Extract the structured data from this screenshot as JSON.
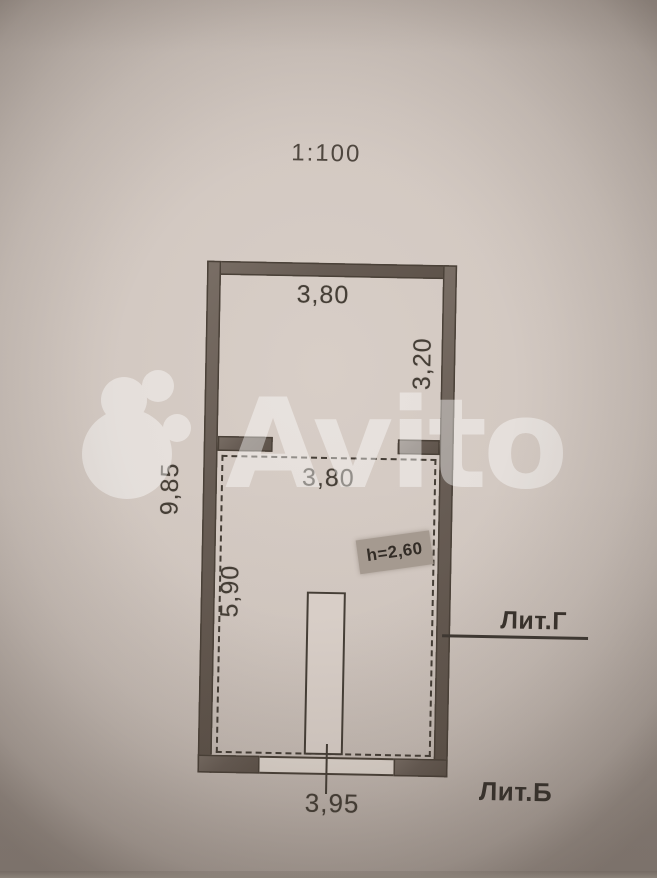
{
  "photo": {
    "scale_label": "1:100",
    "watermark_text": "Avito"
  },
  "upper_room": {
    "width_dim": "3,80",
    "depth_dim": "3,20"
  },
  "lower_room": {
    "width_dim": "3,80",
    "depth_dim": "5,90",
    "ceiling_height_stamp": "h=2,60"
  },
  "overall": {
    "total_depth_dim": "9,85",
    "bottom_width_dim": "3,95"
  },
  "building_labels": {
    "lit_g": "Лит.Г",
    "lit_b": "Лит.Б"
  },
  "colors": {
    "paper": "#d2c8c1",
    "wall_fill": "#675c54",
    "line": "#453e36",
    "stamp_bg": "#a59a90",
    "watermark_white": "#ffffff"
  }
}
